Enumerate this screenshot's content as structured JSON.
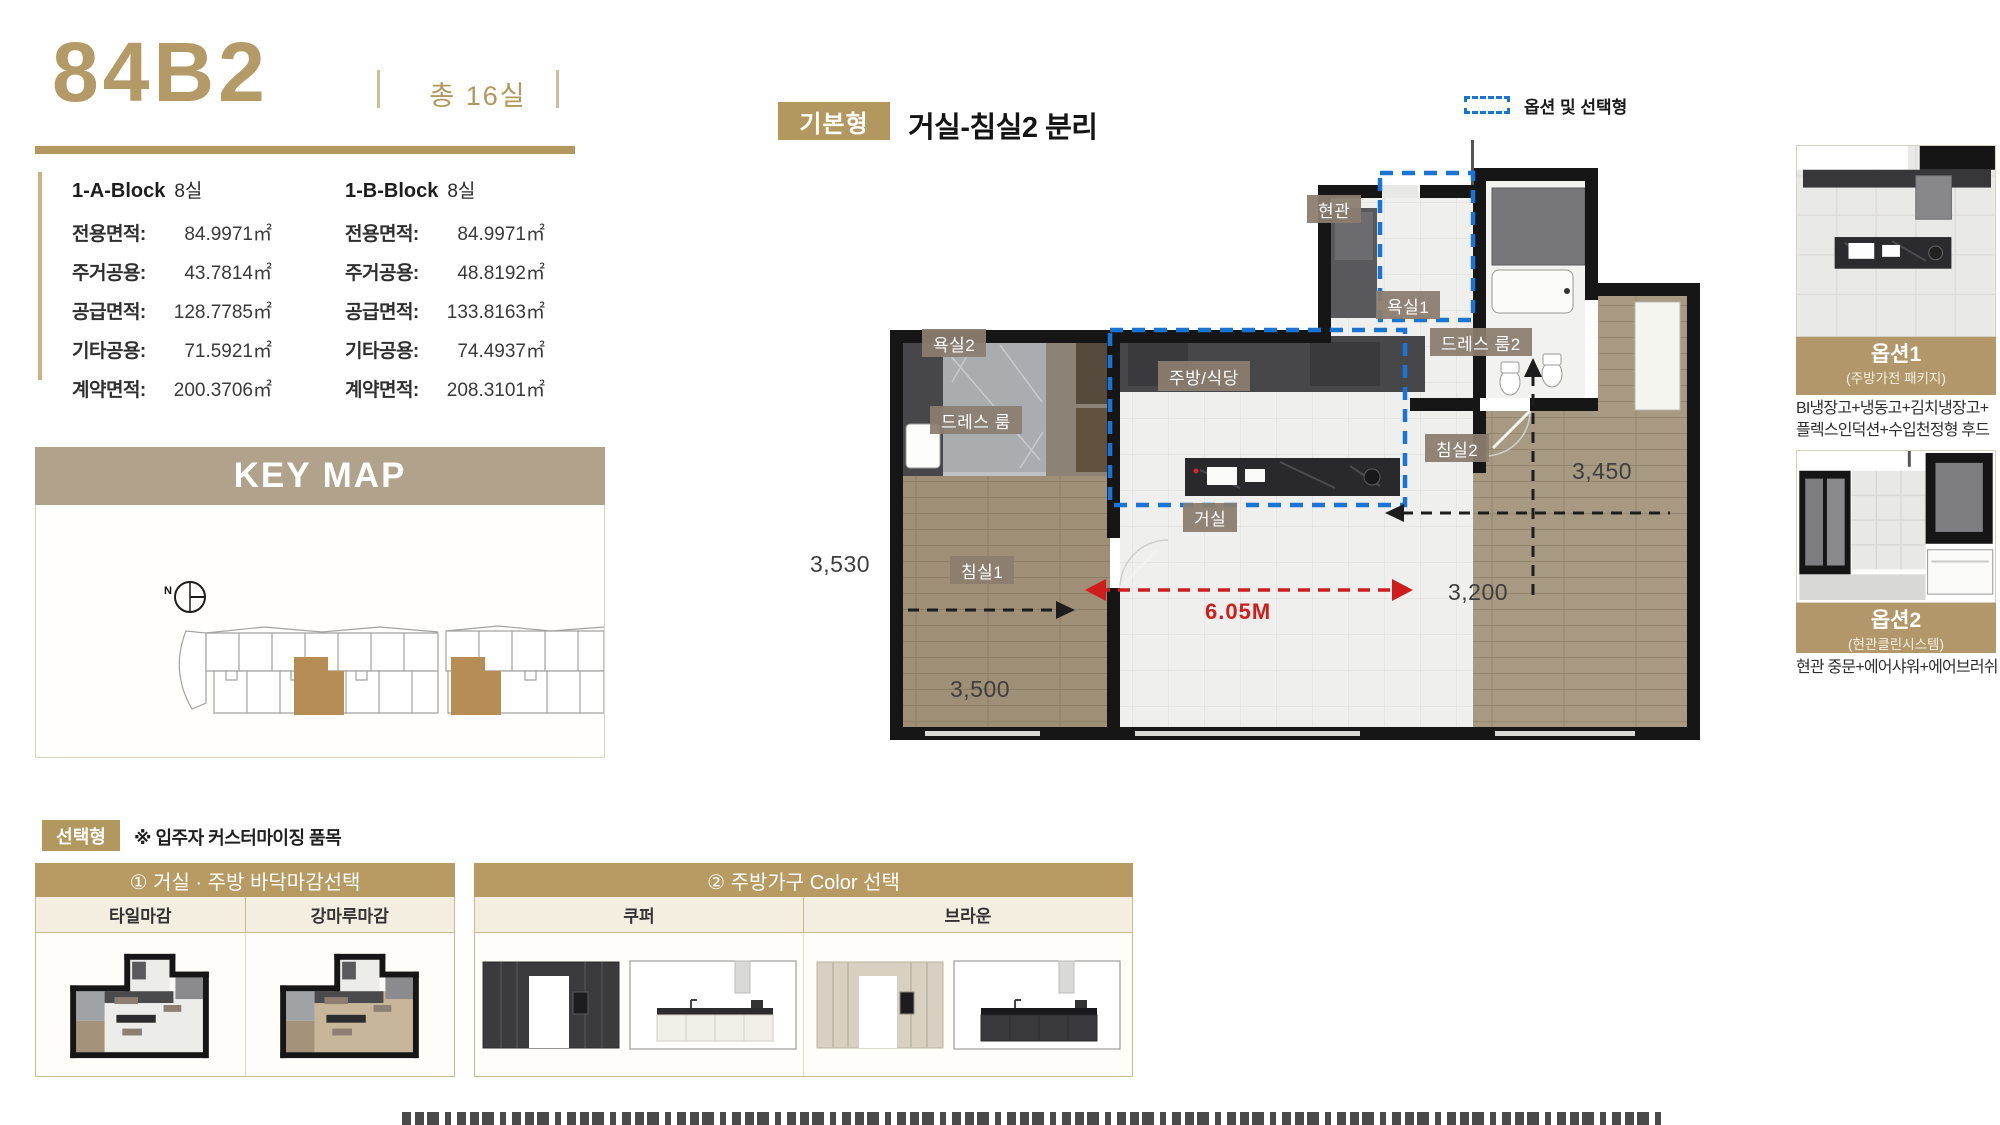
{
  "colors": {
    "gold": "#b2975f",
    "tan_header": "#b1a28b",
    "section_gold": "#b79b62",
    "chip_brown": "#8c7e72",
    "option_blue": "#1a74d6",
    "dimension_red": "#cf1d1d"
  },
  "header": {
    "unit_code": "84B2",
    "total_label": "총 16실"
  },
  "area_table": {
    "blocks": [
      {
        "name": "1-A-Block",
        "rooms": "8실",
        "rows": [
          {
            "label": "전용면적:",
            "value": "84.9971㎡"
          },
          {
            "label": "주거공용:",
            "value": "43.7814㎡"
          },
          {
            "label": "공급면적:",
            "value": "128.7785㎡"
          },
          {
            "label": "기타공용:",
            "value": "71.5921㎡"
          },
          {
            "label": "계약면적:",
            "value": "200.3706㎡"
          }
        ]
      },
      {
        "name": "1-B-Block",
        "rooms": "8실",
        "rows": [
          {
            "label": "전용면적:",
            "value": "84.9971㎡"
          },
          {
            "label": "주거공용:",
            "value": "48.8192㎡"
          },
          {
            "label": "공급면적:",
            "value": "133.8163㎡"
          },
          {
            "label": "기타공용:",
            "value": "74.4937㎡"
          },
          {
            "label": "계약면적:",
            "value": "208.3101㎡"
          }
        ]
      }
    ]
  },
  "keymap": {
    "title": "KEY MAP",
    "north": "N"
  },
  "plan": {
    "badge": "기본형",
    "subtitle": "거실-침실2 분리",
    "legend": "옵션 및 선택형",
    "labels": {
      "entrance": "현관",
      "bath1": "욕실1",
      "dress2": "드레스 룸2",
      "bath2": "욕실2",
      "kitchen": "주방/식당",
      "dress": "드레스 룸",
      "bed2": "침실2",
      "living": "거실",
      "bed1": "침실1"
    },
    "dims": {
      "left": "3,530",
      "bed1": "3,500",
      "bed2_upper": "3,450",
      "bed2_lower": "3,200",
      "living_width": "6.05M"
    }
  },
  "options": [
    {
      "title": "옵션1",
      "subtitle": "(주방가전 패키지)",
      "desc_line1": "BI냉장고+냉동고+김치냉장고+",
      "desc_line2": "플렉스인덕션+수입천정형 후드"
    },
    {
      "title": "옵션2",
      "subtitle": "(현관클린시스템)",
      "desc_line1": "현관 중문+에어샤워+에어브러쉬",
      "desc_line2": ""
    }
  ],
  "custom": {
    "badge": "선택형",
    "note": "※ 입주자 커스터마이징 품목",
    "panels": [
      {
        "title": "① 거실 · 주방 바닥마감선택",
        "columns": [
          "타일마감",
          "강마루마감"
        ]
      },
      {
        "title": "② 주방가구 Color 선택",
        "columns": [
          "쿠퍼",
          "브라운"
        ]
      }
    ]
  }
}
